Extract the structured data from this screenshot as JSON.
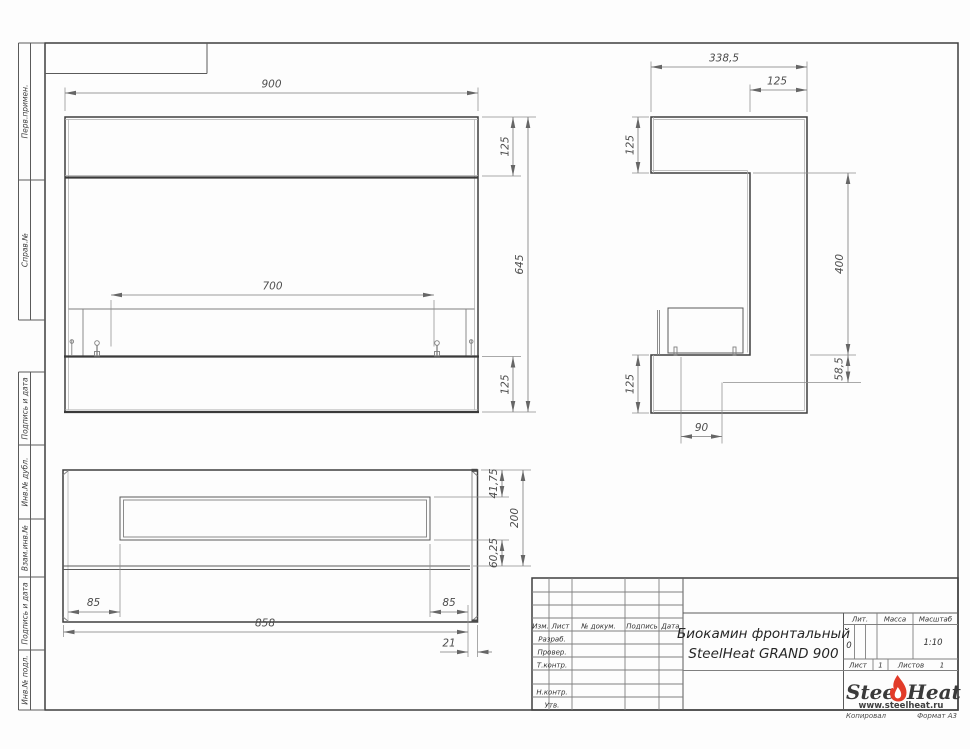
{
  "left_margin": {
    "labels": [
      "Перв.примен.",
      "Справ.№",
      "Подпись и дата",
      "Инв.№ дубл.",
      "Взам.инв.№",
      "Подпись и дата",
      "Инв.№ подл."
    ]
  },
  "views": {
    "front": {
      "dims": {
        "overall_width": "900",
        "top_panel": "125",
        "overall_height": "645",
        "burner_opening": "700",
        "base_panel": "125"
      }
    },
    "side": {
      "dims": {
        "overall_depth": "338,5",
        "column_depth": "125",
        "top_arm_height": "125",
        "opening_height": "400",
        "ledge_height": "58,5",
        "base_height": "125",
        "tank_width": "90"
      }
    },
    "bottom": {
      "dims": {
        "front_offset": "41,75",
        "overall_depth": "200",
        "back_offset": "60,25",
        "left_offset": "85",
        "right_offset": "85",
        "inner_width": "858",
        "wall_thickness": "21"
      }
    }
  },
  "title_block": {
    "header_cols": {
      "izm": "Изм.",
      "list": "Лист",
      "doc": "№ докум.",
      "sign": "Подпись",
      "date": "Дата"
    },
    "rows": {
      "developed": "Разраб.",
      "checked": "Провер.",
      "tcontrol": "Т.контр.",
      "ncontrol": "Н.контр.",
      "approved": "Утв."
    },
    "title_line1": "Биокамин фронтальный",
    "title_line2": "SteelHeat GRAND 900",
    "lit": {
      "label": "Лит.",
      "value": "0"
    },
    "mass": {
      "label": "Масса",
      "value": ""
    },
    "scale": {
      "label": "Масштаб",
      "value": "1:10"
    },
    "sheet": {
      "label": "Лист",
      "value": "1"
    },
    "sheets": {
      "label": "Листов",
      "value": "1"
    },
    "logo": {
      "steel": "Steel",
      "heat": "Heat",
      "site": "www.steelheat.ru"
    },
    "footer": {
      "copied": "Копировал",
      "format": "Формат А3"
    }
  }
}
